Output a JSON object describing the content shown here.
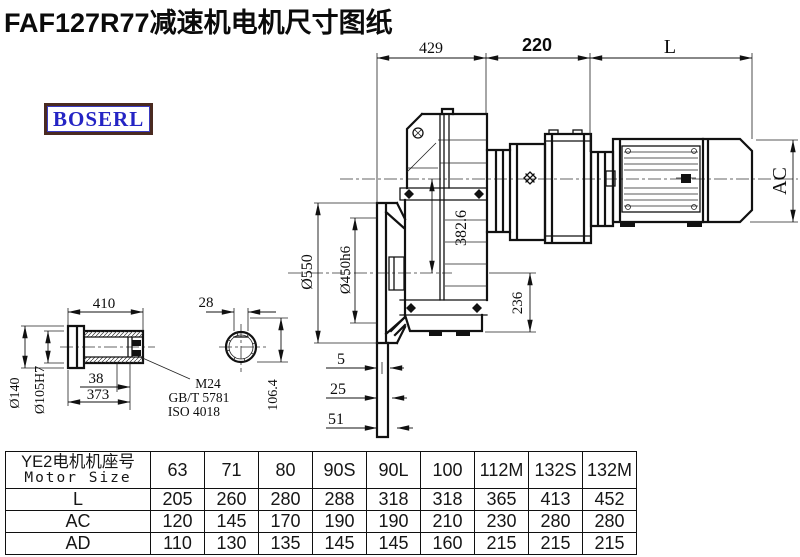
{
  "title": "FAF127R77减速机电机尺寸图纸",
  "logo": {
    "text": "BOSERL"
  },
  "drawing": {
    "dims": {
      "d429": "429",
      "d220": "220",
      "dL": "L",
      "dAC": "AC",
      "d382": "382.6",
      "d236": "236",
      "d550": "Ø550",
      "d450": "Ø450h6",
      "d5": "5",
      "d25": "25",
      "d51": "51",
      "d410": "410",
      "d28": "28",
      "d140": "Ø140",
      "d105": "Ø105H7",
      "d1064": "106.4",
      "d38": "38",
      "d373": "373"
    },
    "notes": {
      "m24": "M24",
      "gbt": "GB/T 5781",
      "iso": "ISO 4018"
    }
  },
  "table": {
    "header": {
      "line1": "YE2电机机座号",
      "line2": "Motor Size"
    },
    "columns": [
      "63",
      "71",
      "80",
      "90S",
      "90L",
      "100",
      "112M",
      "132S",
      "132M"
    ],
    "rows": [
      {
        "label": "L",
        "values": [
          "205",
          "260",
          "280",
          "288",
          "318",
          "318",
          "365",
          "413",
          "452"
        ]
      },
      {
        "label": "AC",
        "values": [
          "120",
          "145",
          "170",
          "190",
          "190",
          "210",
          "230",
          "280",
          "280"
        ]
      },
      {
        "label": "AD",
        "values": [
          "110",
          "130",
          "135",
          "145",
          "145",
          "160",
          "215",
          "215",
          "215"
        ]
      }
    ]
  },
  "colors": {
    "line": "#111111",
    "logo_text": "#2424c4",
    "logo_border": "#4a2a20"
  }
}
